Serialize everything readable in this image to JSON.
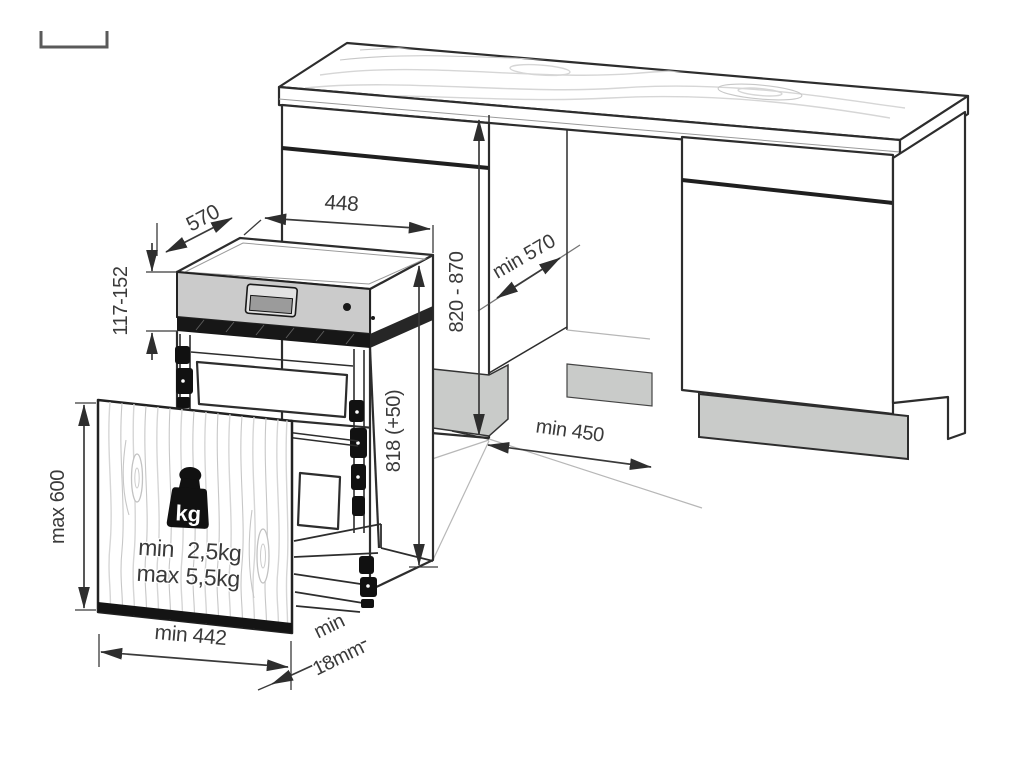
{
  "diagram": {
    "title": "dishwasher-installation-dimensions",
    "labels": {
      "appliance_depth": "570",
      "appliance_width": "448",
      "panel_height": "117-152",
      "appliance_height": "818 (+50)",
      "niche_height": "820 - 870",
      "niche_depth": "min 570",
      "front_clearance": "min 450",
      "door_max_height": "max 600",
      "door_min_width": "min 442",
      "door_thickness_line1": "min",
      "door_thickness_line2": "18mm",
      "weight_badge": "kg",
      "weight_min_label": "min",
      "weight_min_value": "2,5kg",
      "weight_max_label": "max",
      "weight_max_value": "5,5kg"
    },
    "colors": {
      "line": "#2d2d2d",
      "dim_text": "#3a3a3a",
      "panel_gray": "#cbcbcb",
      "display_gray": "#9b9b9b",
      "plinth_gray": "#c9cbc9",
      "band_black": "#171717",
      "band_side_black": "#262626"
    }
  }
}
